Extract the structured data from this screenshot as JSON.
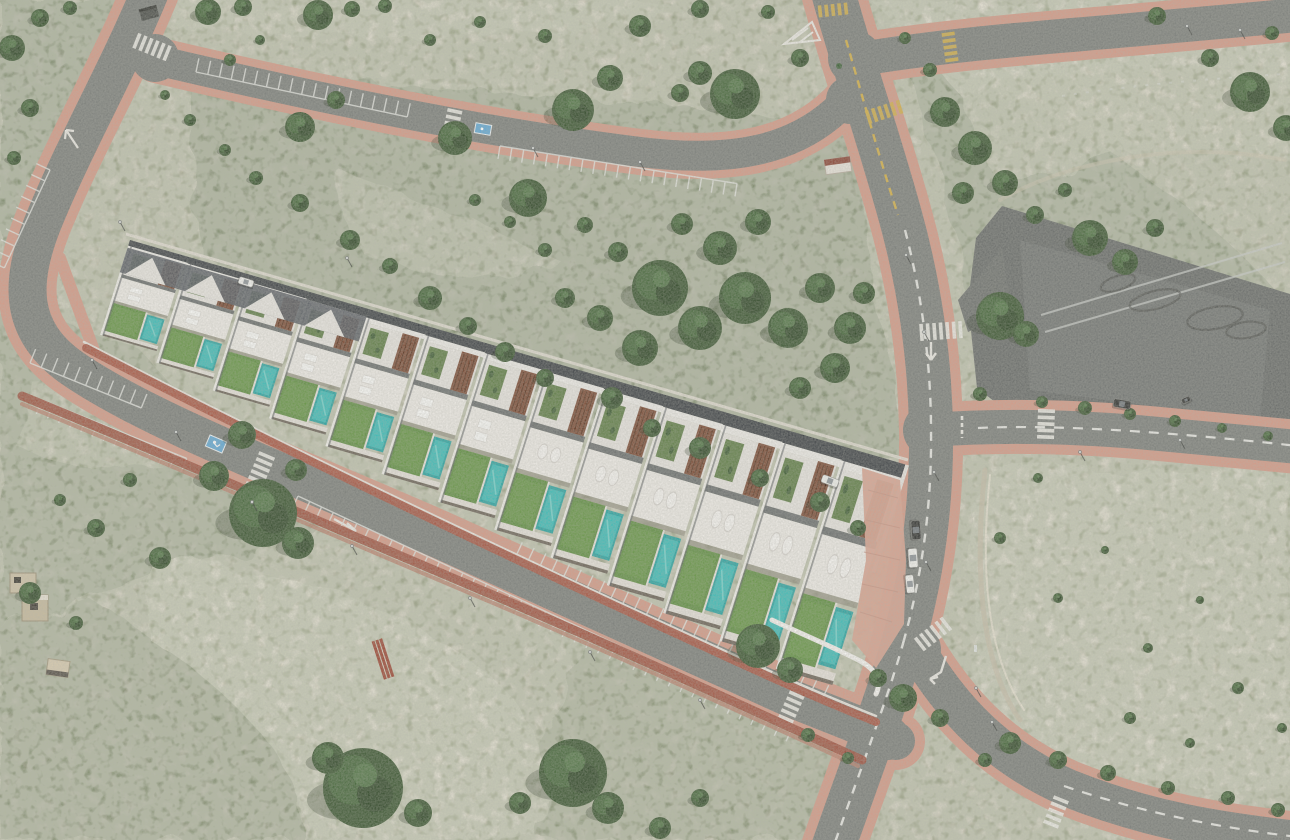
{
  "scene": {
    "type": "aerial-photograph",
    "subject": "Aerial drone view of a new-build row of white townhouses with private pools, composited as a 3D render onto semi-arid Mediterranean scrubland crossed by new roads with terracotta sidewalks, an empty asphalt esplanade with tyre skid marks, crosswalks and parked cars"
  },
  "counts": {
    "townhouses": 13,
    "private_pools": 13,
    "parked_vehicles": 7,
    "white_crosswalks": 8,
    "yellow_crosswalks": 3,
    "parking_rows": 7,
    "trees_and_bushes": 150
  },
  "palette": {
    "sand_base": "#c8c3b0",
    "sand_pale": "#ddd7c7",
    "sand_bright": "#e7e2d4",
    "scrub": "#8b927a",
    "scrub_dark": "#6f7a5e",
    "tree": "#3a5530",
    "tree_dark": "#2c4226",
    "tree_light": "#537748",
    "asphalt": "#7b7e7a",
    "asphalt_dark": "#676a68",
    "sidewalk": "#d59a87",
    "sidewalk_deep": "#c4806b",
    "brick_wall": "#a85441",
    "brick_wall_dark": "#9d4e3c",
    "building_white": "#e8e5e0",
    "terrace_white": "#efece7",
    "shadow_gray": "#565a5f",
    "parapet_dark": "#3e4246",
    "wood_brown": "#7b4a34",
    "wood_slat": "#56321f",
    "lawn": "#5f8e41",
    "lawn_light": "#79a557",
    "pool": "#27a3a1",
    "pool_light": "#3cbcb8",
    "pool_sparkle": "#7fd8d2",
    "marking_white": "#eceae4",
    "marking_yellow": "#d4af45",
    "handicap_blue": "#5fa8d6",
    "car_white": "#f2f2ef",
    "car_dark": "#2e2f2e",
    "paving_pink": "#d9a28f"
  },
  "building": {
    "matrix": [
      0.912,
      0.264,
      -0.3,
      0.95,
      130,
      240
    ],
    "units": 13,
    "unit_len": 65.4,
    "depth_scale_start": 0.86,
    "depth_scale_step": 0.0958
  },
  "trees": [
    [
      208,
      12,
      13
    ],
    [
      243,
      7,
      9
    ],
    [
      318,
      15,
      15
    ],
    [
      352,
      9,
      8
    ],
    [
      385,
      6,
      7
    ],
    [
      300,
      127,
      15
    ],
    [
      336,
      100,
      9
    ],
    [
      455,
      138,
      17
    ],
    [
      528,
      198,
      19
    ],
    [
      573,
      110,
      21
    ],
    [
      610,
      78,
      13
    ],
    [
      680,
      93,
      9
    ],
    [
      735,
      94,
      25
    ],
    [
      700,
      73,
      12
    ],
    [
      640,
      26,
      11
    ],
    [
      700,
      9,
      9
    ],
    [
      768,
      12,
      7
    ],
    [
      800,
      58,
      9
    ],
    [
      545,
      36,
      7
    ],
    [
      480,
      22,
      6
    ],
    [
      430,
      40,
      6
    ],
    [
      230,
      60,
      6
    ],
    [
      260,
      40,
      5
    ],
    [
      660,
      288,
      28
    ],
    [
      700,
      328,
      22
    ],
    [
      745,
      298,
      26
    ],
    [
      788,
      328,
      20
    ],
    [
      820,
      288,
      15
    ],
    [
      720,
      248,
      17
    ],
    [
      758,
      222,
      13
    ],
    [
      682,
      224,
      11
    ],
    [
      850,
      328,
      16
    ],
    [
      864,
      293,
      11
    ],
    [
      640,
      348,
      18
    ],
    [
      600,
      318,
      13
    ],
    [
      565,
      298,
      10
    ],
    [
      835,
      368,
      15
    ],
    [
      800,
      388,
      11
    ],
    [
      618,
      252,
      10
    ],
    [
      585,
      225,
      8
    ],
    [
      545,
      250,
      7
    ],
    [
      510,
      222,
      6
    ],
    [
      475,
      200,
      6
    ],
    [
      430,
      298,
      12
    ],
    [
      468,
      326,
      9
    ],
    [
      505,
      352,
      10
    ],
    [
      545,
      378,
      9
    ],
    [
      612,
      398,
      11
    ],
    [
      652,
      428,
      9
    ],
    [
      700,
      448,
      11
    ],
    [
      760,
      478,
      9
    ],
    [
      820,
      502,
      10
    ],
    [
      858,
      528,
      8
    ],
    [
      945,
      112,
      15
    ],
    [
      975,
      148,
      17
    ],
    [
      1005,
      183,
      13
    ],
    [
      963,
      193,
      11
    ],
    [
      1090,
      238,
      18
    ],
    [
      1125,
      262,
      13
    ],
    [
      1155,
      228,
      9
    ],
    [
      1250,
      92,
      20
    ],
    [
      1286,
      128,
      13
    ],
    [
      1210,
      58,
      9
    ],
    [
      1272,
      33,
      7
    ],
    [
      1157,
      16,
      9
    ],
    [
      1035,
      215,
      9
    ],
    [
      1065,
      190,
      7
    ],
    [
      930,
      70,
      7
    ],
    [
      905,
      38,
      6
    ],
    [
      1000,
      316,
      24
    ],
    [
      1026,
      334,
      13
    ],
    [
      980,
      394,
      7
    ],
    [
      1042,
      402,
      6
    ],
    [
      1085,
      408,
      7
    ],
    [
      1130,
      414,
      6
    ],
    [
      1175,
      421,
      6
    ],
    [
      1222,
      428,
      5
    ],
    [
      1268,
      436,
      5
    ],
    [
      263,
      513,
      34
    ],
    [
      214,
      476,
      15
    ],
    [
      298,
      543,
      16
    ],
    [
      160,
      558,
      11
    ],
    [
      96,
      528,
      9
    ],
    [
      30,
      593,
      11
    ],
    [
      76,
      623,
      7
    ],
    [
      130,
      480,
      7
    ],
    [
      60,
      500,
      6
    ],
    [
      242,
      435,
      14
    ],
    [
      296,
      470,
      11
    ],
    [
      12,
      48,
      13
    ],
    [
      30,
      108,
      9
    ],
    [
      14,
      158,
      7
    ],
    [
      40,
      18,
      9
    ],
    [
      70,
      8,
      7
    ],
    [
      363,
      788,
      40
    ],
    [
      328,
      758,
      16
    ],
    [
      418,
      813,
      14
    ],
    [
      573,
      773,
      34
    ],
    [
      608,
      808,
      16
    ],
    [
      520,
      803,
      11
    ],
    [
      758,
      646,
      22
    ],
    [
      790,
      670,
      13
    ],
    [
      700,
      798,
      9
    ],
    [
      660,
      828,
      11
    ],
    [
      903,
      698,
      14
    ],
    [
      878,
      678,
      9
    ],
    [
      940,
      718,
      9
    ],
    [
      1010,
      743,
      11
    ],
    [
      1058,
      760,
      9
    ],
    [
      1108,
      773,
      8
    ],
    [
      1168,
      788,
      7
    ],
    [
      1228,
      798,
      7
    ],
    [
      1278,
      810,
      7
    ],
    [
      1130,
      718,
      6
    ],
    [
      1190,
      743,
      5
    ],
    [
      985,
      760,
      7
    ],
    [
      808,
      735,
      7
    ],
    [
      848,
      758,
      6
    ],
    [
      1000,
      538,
      6
    ],
    [
      1058,
      598,
      5
    ],
    [
      1148,
      648,
      5
    ],
    [
      1238,
      688,
      6
    ],
    [
      1282,
      728,
      5
    ],
    [
      1038,
      478,
      5
    ],
    [
      1105,
      550,
      4
    ],
    [
      1200,
      600,
      4
    ],
    [
      350,
      240,
      10
    ],
    [
      390,
      266,
      8
    ],
    [
      300,
      203,
      9
    ],
    [
      256,
      178,
      7
    ],
    [
      225,
      150,
      6
    ],
    [
      190,
      120,
      6
    ],
    [
      165,
      95,
      5
    ]
  ],
  "cars": [
    {
      "x": 916,
      "y": 530,
      "a": 86,
      "l": 19,
      "w": 9,
      "c": "car_dark"
    },
    {
      "x": 913,
      "y": 558,
      "a": 86,
      "l": 19,
      "w": 9,
      "c": "car_white"
    },
    {
      "x": 910,
      "y": 584,
      "a": 84,
      "l": 18,
      "w": 8,
      "c": "car_white"
    },
    {
      "x": 830,
      "y": 481,
      "a": 20,
      "l": 17,
      "w": 8,
      "c": "car_white"
    },
    {
      "x": 246,
      "y": 282,
      "a": 17,
      "l": 15,
      "w": 7,
      "c": "car_white"
    },
    {
      "x": 1122,
      "y": 404,
      "a": 10,
      "l": 17,
      "w": 8,
      "c": "car_dark"
    },
    {
      "x": 1186,
      "y": 400,
      "a": -25,
      "l": 9,
      "w": 5,
      "c": "car_dark"
    }
  ],
  "crosswalks": [
    {
      "x": 152,
      "y": 47,
      "a": -68,
      "n": 6,
      "len": 16,
      "c": "marking_white"
    },
    {
      "x": 452,
      "y": 124,
      "a": 12,
      "n": 5,
      "len": 15,
      "c": "marking_white"
    },
    {
      "x": 259,
      "y": 474,
      "a": 23,
      "n": 7,
      "len": 17,
      "c": "marking_white"
    },
    {
      "x": 790,
      "y": 710,
      "a": 24,
      "n": 6,
      "len": 16,
      "c": "marking_white"
    },
    {
      "x": 941,
      "y": 331,
      "a": 86,
      "n": 7,
      "len": 17,
      "c": "marking_white"
    },
    {
      "x": 1046,
      "y": 424,
      "a": 2,
      "n": 5,
      "len": 17,
      "c": "marking_white"
    },
    {
      "x": 933,
      "y": 634,
      "a": 52,
      "n": 6,
      "len": 16,
      "c": "marking_white"
    },
    {
      "x": 1056,
      "y": 812,
      "a": 22,
      "n": 5,
      "len": 16,
      "c": "marking_white"
    },
    {
      "x": 833,
      "y": 10,
      "a": 84,
      "n": 5,
      "len": 12,
      "c": "marking_yellow"
    },
    {
      "x": 884,
      "y": 112,
      "a": 72,
      "n": 6,
      "len": 14,
      "c": "marking_yellow"
    },
    {
      "x": 950,
      "y": 47,
      "a": -8,
      "n": 5,
      "len": 13,
      "c": "marking_yellow"
    }
  ],
  "parking_rows": [
    {
      "x": 30,
      "y": 363,
      "a": 22,
      "n": 10,
      "pitch": 12,
      "tick": -15
    },
    {
      "x": 42,
      "y": 400,
      "a": 22,
      "n": 13,
      "pitch": 12,
      "tick": 15
    },
    {
      "x": 298,
      "y": 496,
      "a": 25,
      "n": 42,
      "pitch": 13,
      "tick": 16
    },
    {
      "x": 516,
      "y": 556,
      "a": 25,
      "n": 26,
      "pitch": 13,
      "tick": -15
    },
    {
      "x": 196,
      "y": 72,
      "a": 12,
      "n": 18,
      "pitch": 12,
      "tick": -14
    },
    {
      "x": 500,
      "y": 146,
      "a": 9,
      "n": 20,
      "pitch": 12,
      "tick": 13
    },
    {
      "x": 50,
      "y": 170,
      "a": 115,
      "n": 9,
      "pitch": 12,
      "tick": 15
    }
  ],
  "poles": [
    [
      347,
      258
    ],
    [
      92,
      360
    ],
    [
      176,
      432
    ],
    [
      252,
      502
    ],
    [
      352,
      546
    ],
    [
      470,
      598
    ],
    [
      590,
      652
    ],
    [
      700,
      700
    ],
    [
      533,
      148
    ],
    [
      640,
      162
    ],
    [
      906,
      255
    ],
    [
      924,
      332
    ],
    [
      934,
      472
    ],
    [
      926,
      562
    ],
    [
      976,
      688
    ],
    [
      992,
      722
    ],
    [
      1080,
      452
    ],
    [
      1180,
      440
    ],
    [
      1240,
      30
    ],
    [
      1187,
      26
    ],
    [
      120,
      222
    ]
  ],
  "skid_marks": [
    [
      1155,
      300,
      26,
      9,
      -14
    ],
    [
      1215,
      318,
      28,
      11,
      -10
    ],
    [
      1118,
      283,
      18,
      7,
      -18
    ],
    [
      1246,
      330,
      20,
      8,
      -8
    ]
  ],
  "esplanade_lines": [
    [
      1045,
      332,
      1285,
      262
    ],
    [
      1041,
      315,
      1282,
      243
    ]
  ]
}
